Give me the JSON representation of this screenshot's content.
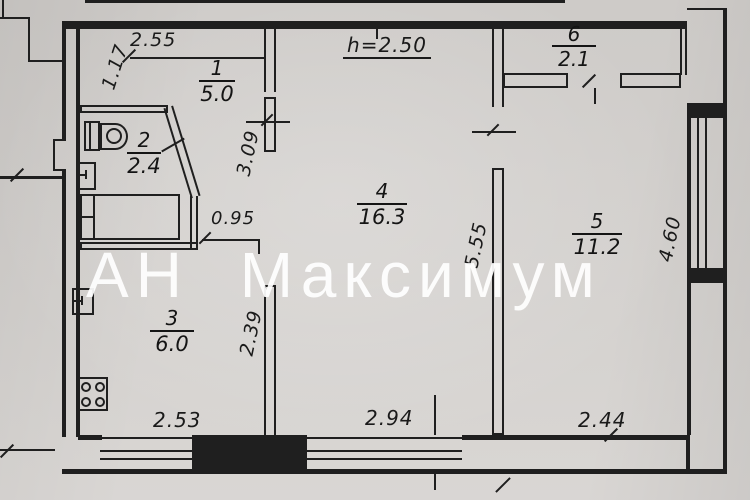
{
  "watermark": "АН Максимум",
  "ceiling_note": "h=2.50",
  "rooms": [
    {
      "number": "1",
      "area": "5.0"
    },
    {
      "number": "2",
      "area": "2.4"
    },
    {
      "number": "3",
      "area": "6.0"
    },
    {
      "number": "4",
      "area": "16.3"
    },
    {
      "number": "5",
      "area": "11.2"
    },
    {
      "number": "6",
      "area": "2.1"
    }
  ],
  "dimensions": {
    "hall_width_top": "2.55",
    "entry_depth": "1.17",
    "corridor_width": "0.95",
    "room4_wall_left": "3.09",
    "kitchen_wall_right": "2.39",
    "room4_wall_right": "5.55",
    "room5_wall_right": "4.60",
    "kitchen_width_bottom": "2.53",
    "room4_width_bottom": "2.94",
    "room5_width_bottom": "2.44"
  },
  "colors": {
    "paper": "#d6d3d0",
    "ink": "#1f1f1f",
    "watermark": "#ffffff"
  }
}
